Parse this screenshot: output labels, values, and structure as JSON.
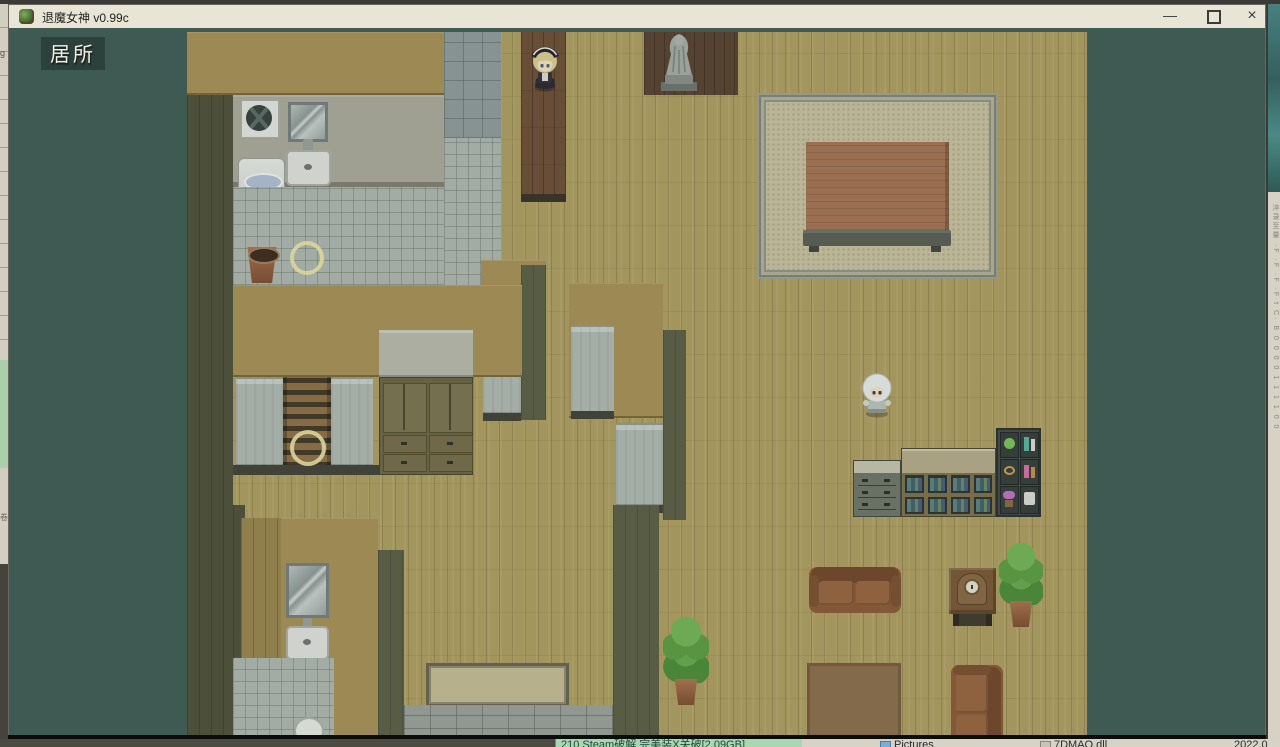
{
  "window": {
    "title": "退魔女神 v0.99c",
    "controls": {
      "minimize": "—",
      "close": "×"
    }
  },
  "game": {
    "map_label": "居所"
  },
  "background_windows": {
    "left_edge": {
      "top_char": "g",
      "mid_char": "卷"
    },
    "right_edge": {
      "fragments": "淬录至量 ·F ·F ·F ·F t C· B 0 0 0 0 1 1 1 1 0 0"
    },
    "bottom_bar": {
      "archive_item": "210 Steam破解 完美装X关破[2.09GB]",
      "folder_item": "Pictures",
      "file_item": "7DMAO.dll",
      "date_fragment": "2022.0"
    }
  },
  "colors": {
    "titlebar": "#e9e5d6",
    "game_background": "#3e5a53",
    "floor": "#ac9d62",
    "wall": "#a59057",
    "event_ring": "#e9e0a4",
    "taskbar_green": "#a9d7b1"
  }
}
